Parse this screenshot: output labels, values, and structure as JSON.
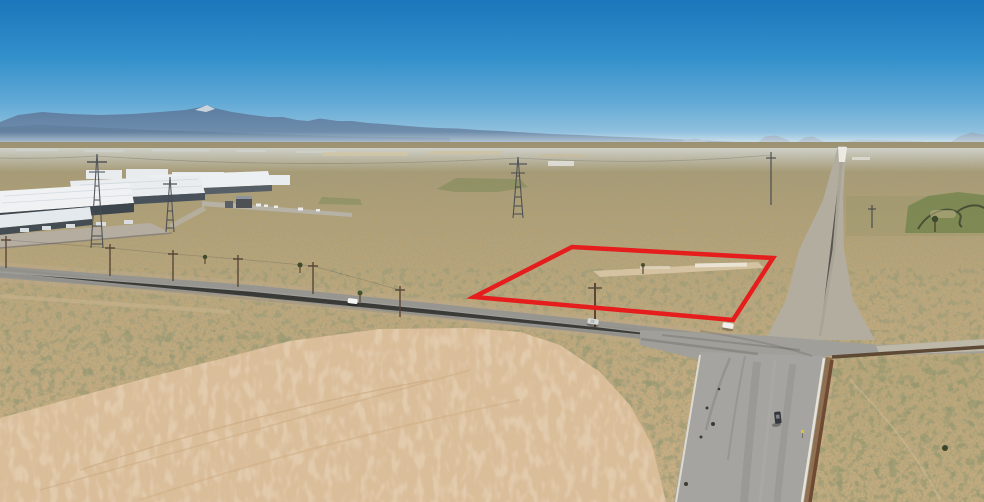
{
  "meta": {
    "type": "aerial-drone-photo",
    "description": "Aerial drone photograph of vacant high-desert land. A bright red quadrilateral outlines a parcel beside a paved road intersection; a white-roofed industrial warehouse campus sits at left, hazy blue mountain ranges line the horizon under a clear gradient sky, a dirt road recedes to a vanishing point at right, and a large cleared dirt pad fills the foreground.",
    "width_px": 984,
    "height_px": 502
  },
  "annotation": {
    "parcel_outline": {
      "label": "highlighted-parcel-boundary",
      "points": "572,247 773,258 733,320 474,297",
      "stroke": "#e51d1d",
      "stroke_width": 4.5
    }
  },
  "palette": {
    "sky_top": "#1b76bb",
    "sky_horizon": "#b7d4e5",
    "mountains": "#5b7ba0",
    "haze": "#e8eff3",
    "desert_far": "#9c9273",
    "desert_near": "#ccb084",
    "scrub_olive": "#545433",
    "cleared_dirt": "#dabd99",
    "paved_road": "#96958f",
    "south_road": "#a5a4a0",
    "dirt_road": "#b3ada0",
    "wall_brown": "#6e4a33",
    "roof_white": "#eef1f3",
    "building_side": "#3f474e",
    "wetland_green": "#77864f",
    "outline_red": "#e51d1d"
  },
  "scene": {
    "vehicles": [
      {
        "id": "white-car-west-road",
        "transform": "translate(348,298) rotate(7)",
        "w": 10,
        "h": 5,
        "color": "#f4f4f2"
      },
      {
        "id": "silver-car-west-road",
        "transform": "translate(588,318) rotate(8)",
        "w": 11,
        "h": 5.5,
        "color": "#d9dad8"
      },
      {
        "id": "white-car-intersection",
        "transform": "translate(723,322) rotate(9)",
        "w": 11,
        "h": 5.5,
        "color": "#f0efec"
      },
      {
        "id": "dark-car-south-road",
        "transform": "translate(774,412) rotate(-6)",
        "w": 6.5,
        "h": 12,
        "color": "#34383c"
      }
    ],
    "road_sign": {
      "color": "#ddc13e"
    }
  }
}
